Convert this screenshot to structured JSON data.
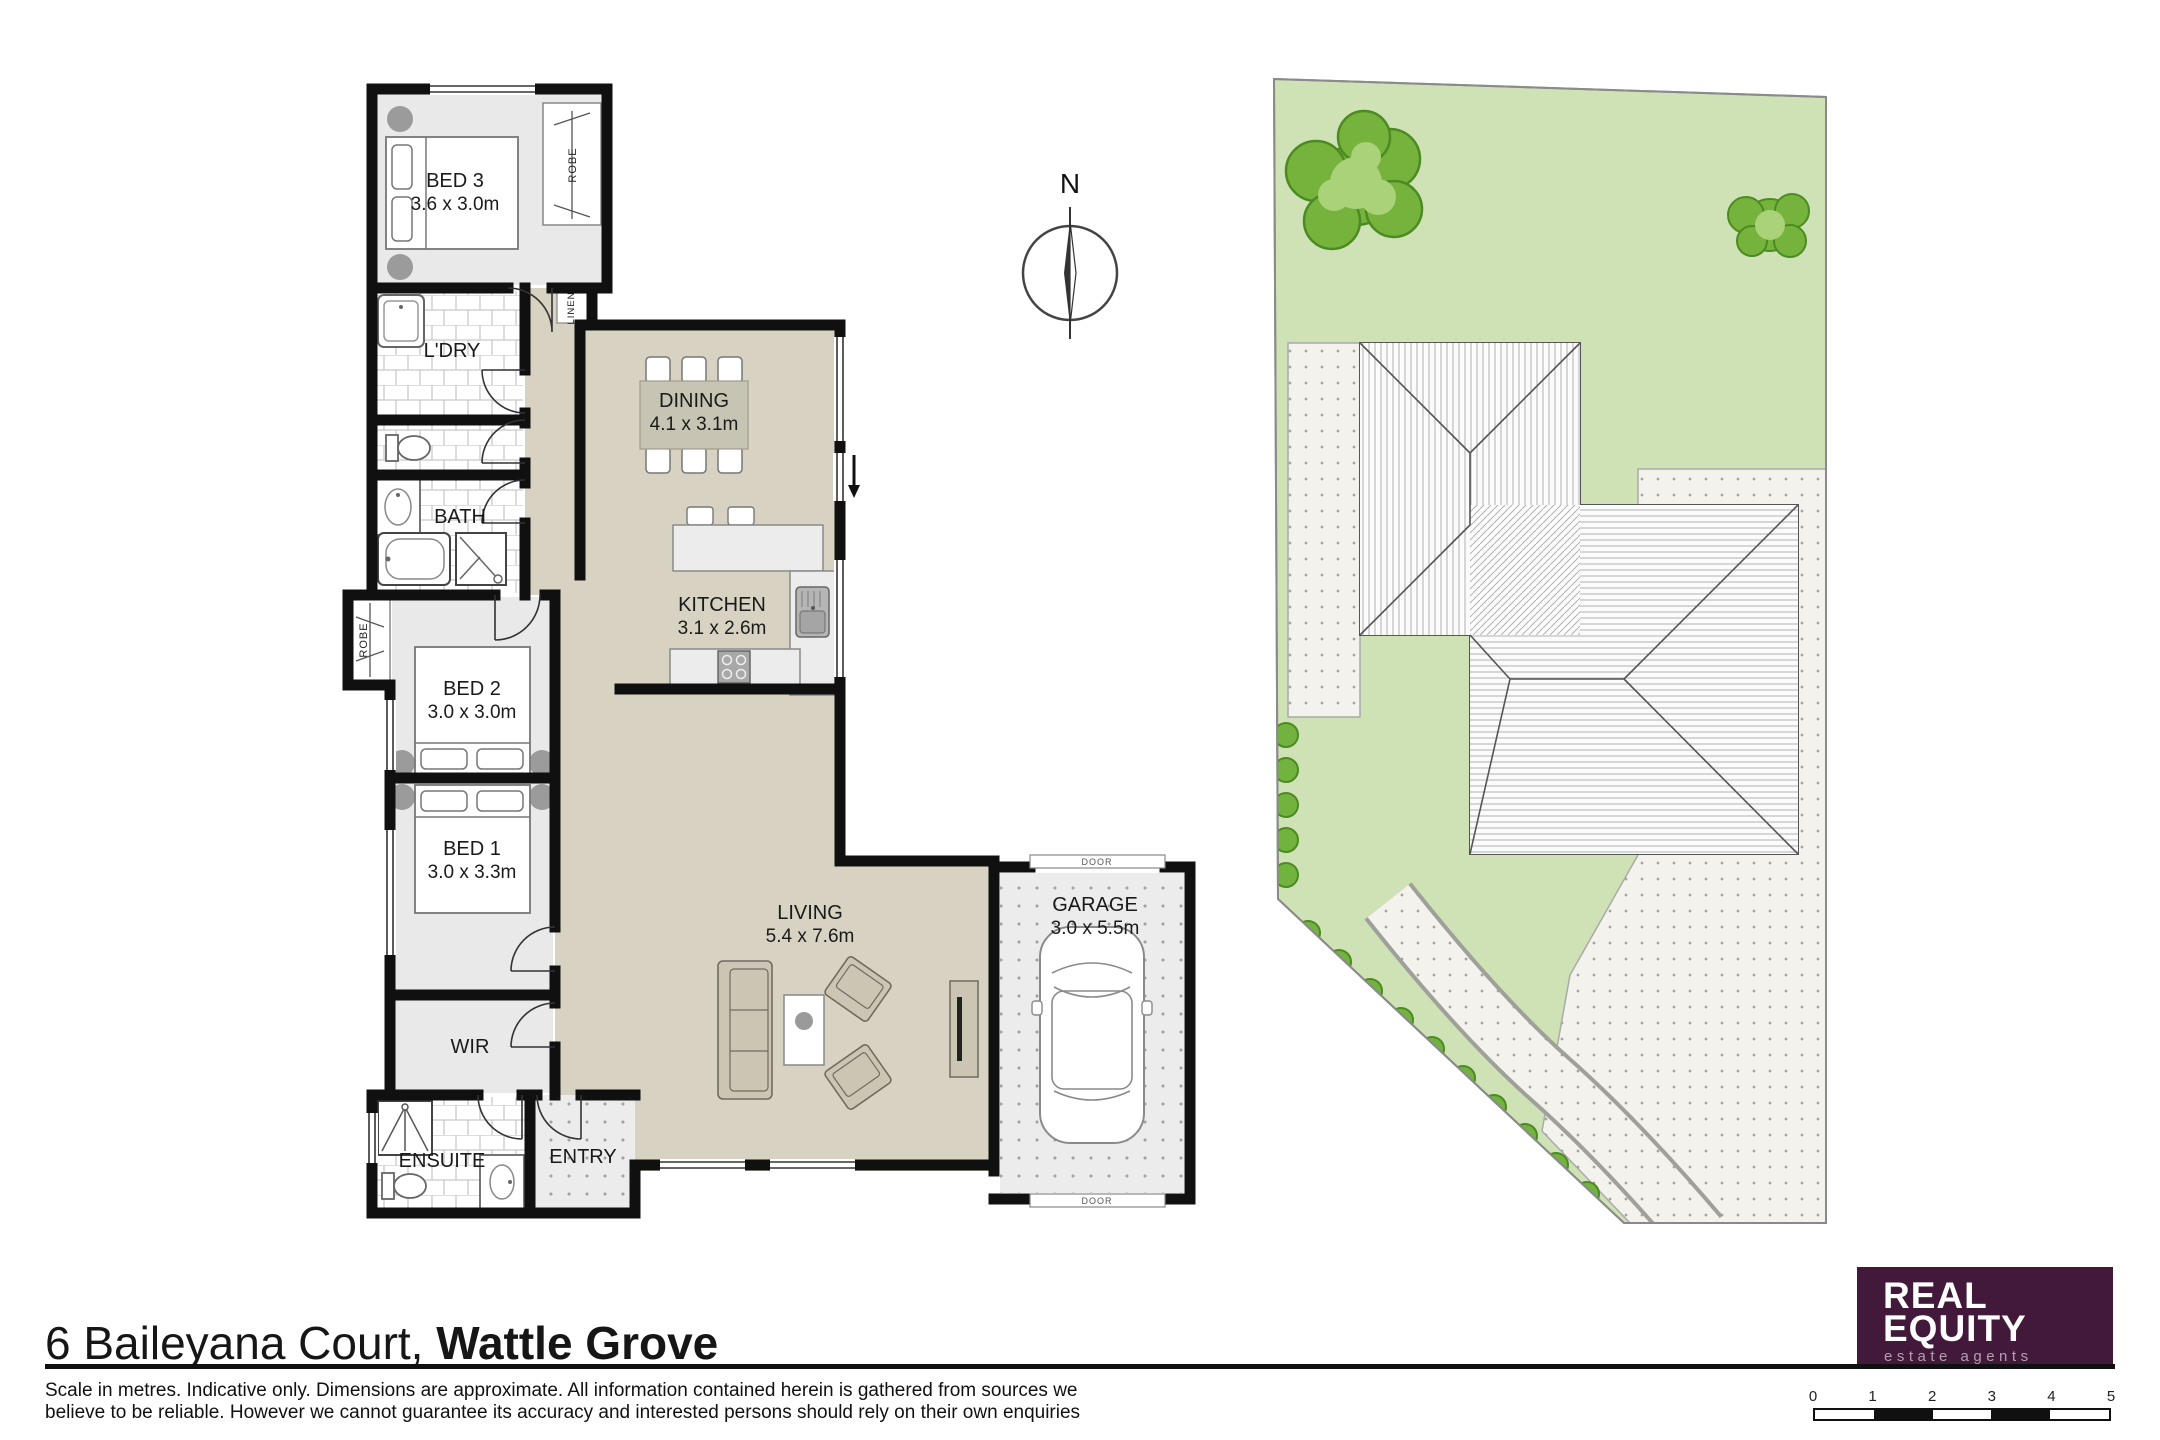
{
  "address": {
    "street": "6 Baileyana Court,",
    "suburb": " Wattle Grove"
  },
  "disclaimer": {
    "line1": "Scale in metres. Indicative only. Dimensions are approximate. All information contained herein is gathered from sources we",
    "line2": "believe to be reliable. However we cannot guarantee its accuracy and interested persons should rely on their own enquiries"
  },
  "compass": {
    "label": "N"
  },
  "rooms": {
    "bed3": {
      "name": "BED 3",
      "dims": "3.6 x 3.0m"
    },
    "ldry": {
      "name": "L'DRY"
    },
    "bath": {
      "name": "BATH"
    },
    "bed2": {
      "name": "BED 2",
      "dims": "3.0 x 3.0m"
    },
    "bed1": {
      "name": "BED 1",
      "dims": "3.0 x 3.3m"
    },
    "wir": {
      "name": "WIR"
    },
    "ensuite": {
      "name": "ENSUITE"
    },
    "entry": {
      "name": "ENTRY"
    },
    "dining": {
      "name": "DINING",
      "dims": "4.1 x 3.1m"
    },
    "kitchen": {
      "name": "KITCHEN",
      "dims": "3.1 x 2.6m"
    },
    "living": {
      "name": "LIVING",
      "dims": "5.4 x 7.6m"
    },
    "garage": {
      "name": "GARAGE",
      "dims": "3.0 x 5.5m"
    }
  },
  "closets": {
    "robe_bed3": "ROBE",
    "robe_bed2": "ROBE",
    "linen": "LINEN"
  },
  "garage_door": {
    "top": "DOOR",
    "bottom": "DOOR"
  },
  "scale_bar": {
    "ticks": [
      "0",
      "1",
      "2",
      "3",
      "4",
      "5"
    ]
  },
  "logo": {
    "line1": "REAL",
    "line2": "EQUITY",
    "tagline": "estate agents"
  },
  "colors": {
    "floor_beige": "#d7d2c2",
    "room_grey": "#e9e9e9",
    "wall": "#101010",
    "lawn": "#cfe2b6",
    "tree": "#76b33c",
    "shrub": "#72b23e",
    "concrete": "#f3f2ec",
    "logo_bg": "#43193b"
  }
}
